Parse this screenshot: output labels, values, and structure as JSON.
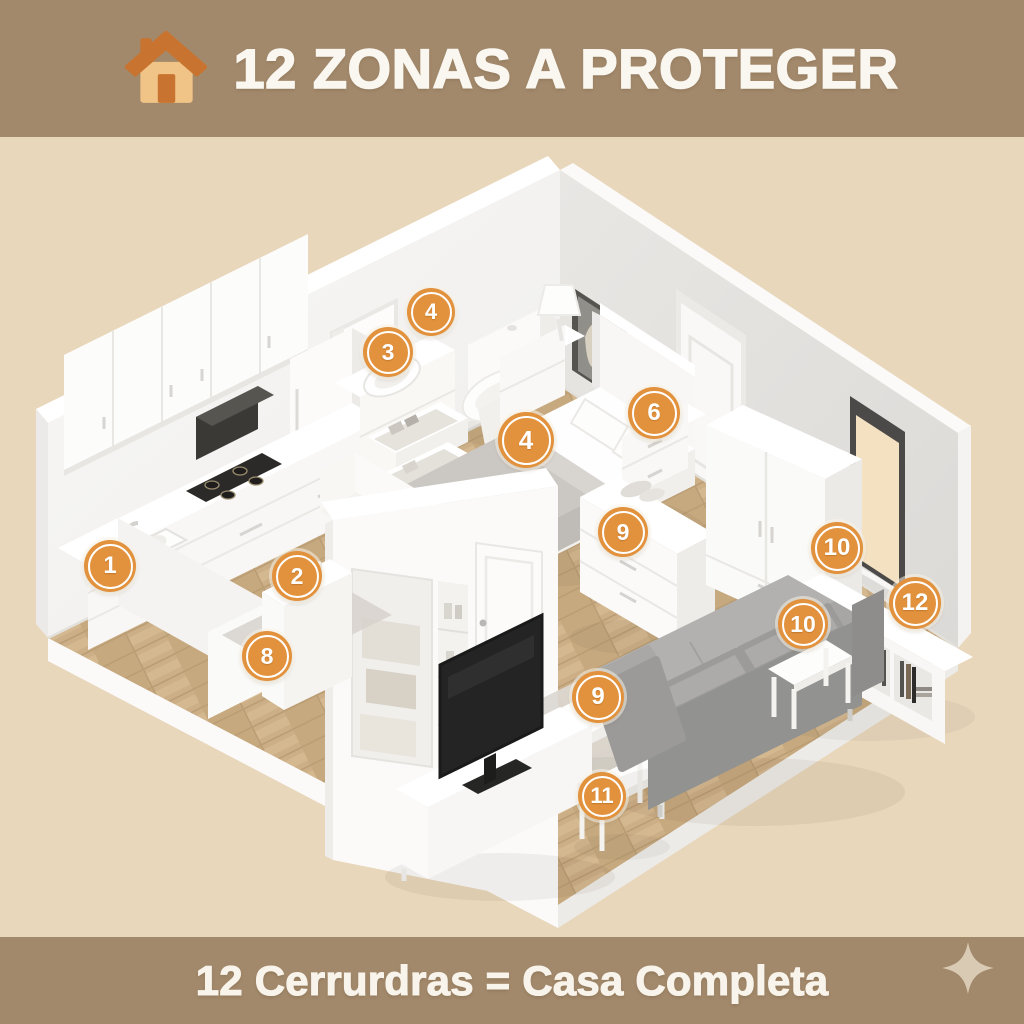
{
  "header": {
    "title": "12 ZONAS A PROTEGER",
    "icon": "house-icon"
  },
  "footer": {
    "caption": "12 Cerrurdras = Casa Completa",
    "icon": "sparkle-icon"
  },
  "markers": [
    {
      "label": "1",
      "x": 110,
      "y": 566,
      "size": 52
    },
    {
      "label": "2",
      "x": 297,
      "y": 576,
      "size": 50
    },
    {
      "label": "3",
      "x": 388,
      "y": 352,
      "size": 50
    },
    {
      "label": "4",
      "x": 431,
      "y": 312,
      "size": 48
    },
    {
      "label": "4",
      "x": 526,
      "y": 440,
      "size": 56
    },
    {
      "label": "6",
      "x": 654,
      "y": 413,
      "size": 52
    },
    {
      "label": "8",
      "x": 267,
      "y": 656,
      "size": 50
    },
    {
      "label": "9",
      "x": 623,
      "y": 532,
      "size": 50
    },
    {
      "label": "9",
      "x": 598,
      "y": 697,
      "size": 52
    },
    {
      "label": "10",
      "x": 837,
      "y": 548,
      "size": 52
    },
    {
      "label": "10",
      "x": 803,
      "y": 624,
      "size": 50
    },
    {
      "label": "11",
      "x": 602,
      "y": 796,
      "size": 48
    },
    {
      "label": "12",
      "x": 915,
      "y": 603,
      "size": 52
    }
  ],
  "colors": {
    "band": "#a3896b",
    "background": "#e9d7bc",
    "marker_fill": "#e2913c",
    "marker_text": "#ffffff",
    "floor_wood": "#cdb189",
    "wall_left": "#f6f5f3",
    "wall_right": "#e5e3e0",
    "sofa_gray": "#929290",
    "accent_house": "#c8732f"
  }
}
